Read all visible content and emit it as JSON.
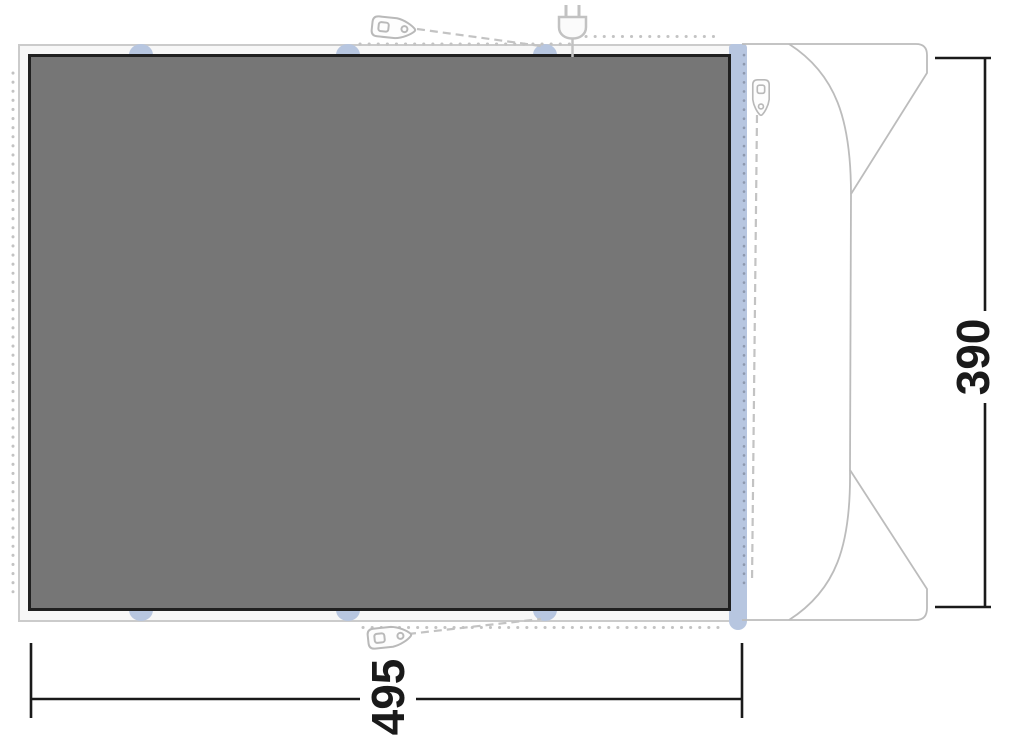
{
  "diagram": {
    "dimensions": {
      "width_cm": "495",
      "depth_cm": "390"
    },
    "icons": {
      "peg_top": "tent-peg-icon",
      "peg_bottom": "tent-peg-icon",
      "peg_side": "tent-peg-icon",
      "plug": "power-plug-icon",
      "vehicle": "vehicle-outline"
    },
    "colors": {
      "tarp-fill": "#767676",
      "tarp-border": "#202020",
      "frame-fill": "#f7f7f7",
      "frame-border": "#cbcbcb",
      "attachment-blue": "#b7c6e0",
      "line-gray": "#c3c3c3",
      "vehicle-gray": "#bcbcbc",
      "dim-black": "#1a1a1a"
    }
  }
}
